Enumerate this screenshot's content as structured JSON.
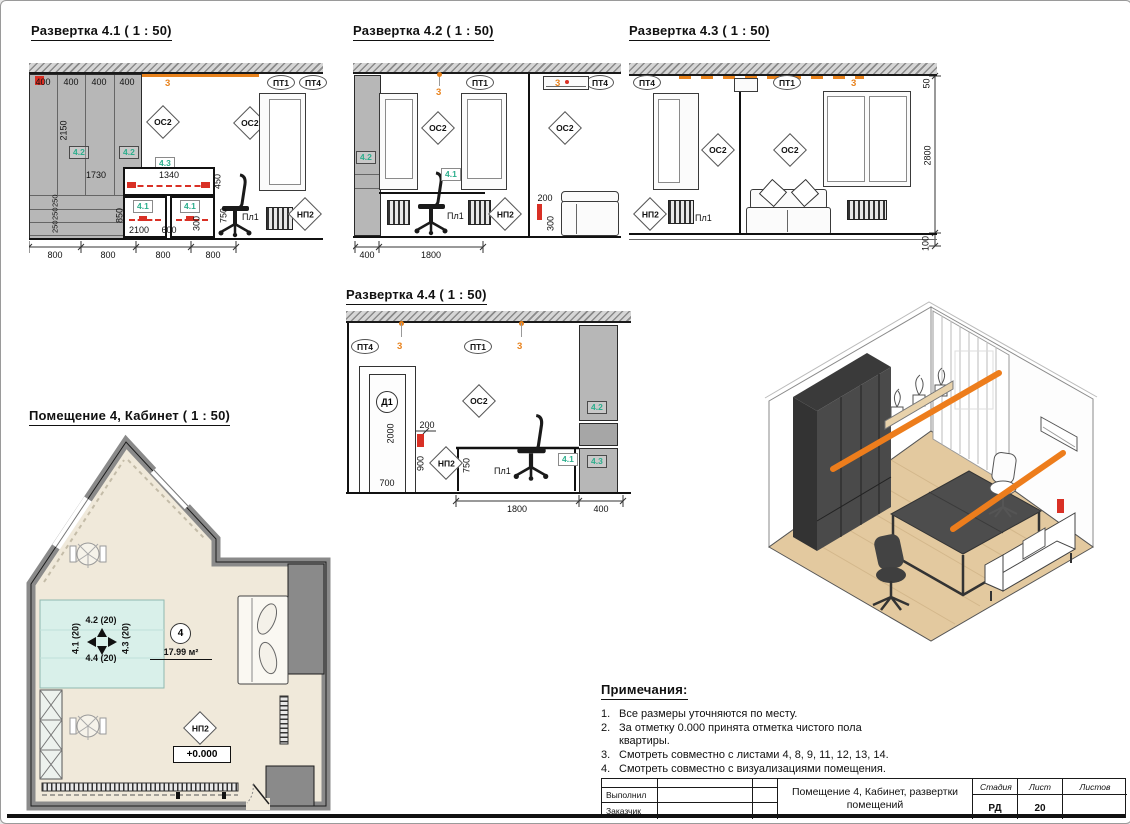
{
  "colors": {
    "orange": "#E8821C",
    "tag_green": "#2BAE8C",
    "red": "#D93025"
  },
  "elev41": {
    "title": "Развертка 4.1 ( 1 : 50)",
    "led": "3",
    "d400": "400",
    "d2150": "2150",
    "d250": "250",
    "d1730": "1730",
    "d1340": "1340",
    "d450": "450",
    "d850": "850",
    "d750": "750",
    "d2100": "2100",
    "d600": "600",
    "d300": "300",
    "d800": "800",
    "os2": "ОС2",
    "pt1": "ПТ1",
    "pt4": "ПТ4",
    "pl1": "Пл1",
    "np2": "НП2",
    "t41": "4.1",
    "t42": "4.2",
    "t43": "4.3"
  },
  "elev42": {
    "title": "Развертка 4.2 ( 1 : 50)",
    "led": "3",
    "d200": "200",
    "d300": "300",
    "d400": "400",
    "d1800": "1800",
    "os2": "ОС2",
    "pt1": "ПТ1",
    "pt4": "ПТ4",
    "pl1": "Пл1",
    "np2": "НП2",
    "t41": "4.1",
    "t42": "4.2"
  },
  "elev43": {
    "title": "Развертка 4.3 ( 1 : 50)",
    "led": "3",
    "d50": "50",
    "d2800": "2800",
    "d100": "100",
    "os2": "ОС2",
    "pt1": "ПТ1",
    "pt4": "ПТ4",
    "pl1": "Пл1",
    "np2": "НП2"
  },
  "elev44": {
    "title": "Развертка 4.4 ( 1 : 50)",
    "led": "3",
    "d2000": "2000",
    "d700": "700",
    "d200": "200",
    "d900": "900",
    "d750": "750",
    "d1800": "1800",
    "d400": "400",
    "door": "Д1",
    "os2": "ОС2",
    "pt1": "ПТ1",
    "pt4": "ПТ4",
    "pl1": "Пл1",
    "np2": "НП2",
    "t41": "4.1",
    "t42": "4.2",
    "t43": "4.3"
  },
  "plan": {
    "title": "Помещение 4, Кабинет ( 1 : 50)",
    "room_number": "4",
    "area": "17.99 м²",
    "level": "+0.000",
    "np2": "НП2",
    "nav_up": "4.2 (20)",
    "nav_left": "4.1 (20)",
    "nav_right": "4.3 (20)",
    "nav_down": "4.4 (20)"
  },
  "notes": {
    "title": "Примечания:",
    "items": [
      {
        "n": "1.",
        "text": "Все размеры уточняются по месту."
      },
      {
        "n": "2.",
        "text": "За отметку 0.000 принята отметка чистого пола квартиры."
      },
      {
        "n": "3.",
        "text": "Смотреть совместно с листами 4, 8, 9, 11, 12, 13, 14."
      },
      {
        "n": "4.",
        "text": "Смотреть совместно с визуализациями помещения."
      }
    ]
  },
  "titleblock": {
    "executed_label": "Выполнил",
    "customer_label": "Заказчик",
    "doc_title": "Помещение 4, Кабинет, развертки помещений",
    "stage_label": "Стадия",
    "sheet_label": "Лист",
    "sheets_label": "Листов",
    "stage_value": "РД",
    "sheet_value": "20",
    "sheets_value": ""
  }
}
